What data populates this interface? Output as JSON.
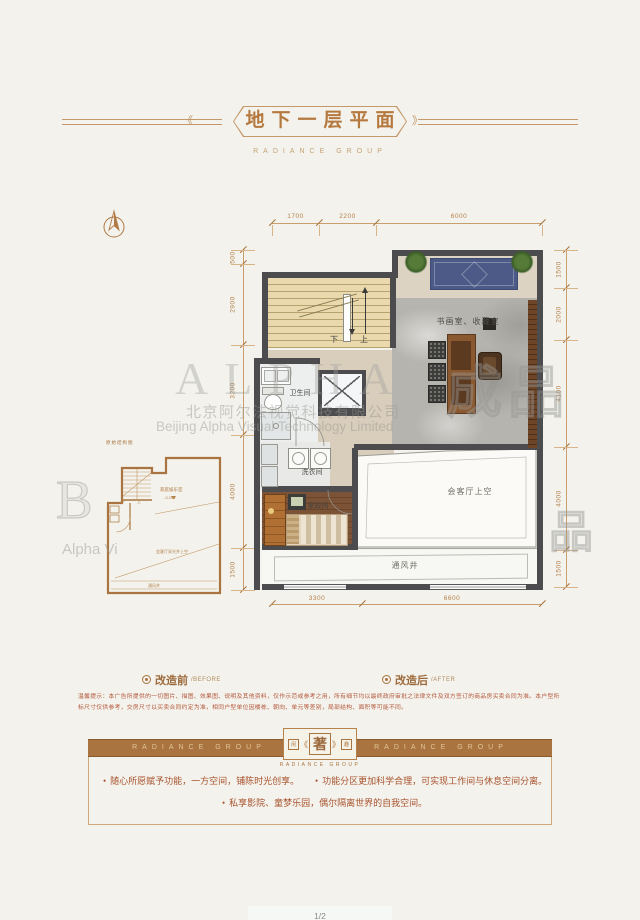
{
  "header": {
    "title": "地下一层平面",
    "subtitle": "RADIANCE GROUP",
    "decor_l": "《",
    "decor_r": "》"
  },
  "plan": {
    "room_labels": {
      "study": "书画室、收藏室",
      "bathroom": "卫生间",
      "laundry": "洗衣间",
      "maid": "家政间",
      "void": "会客厅上空",
      "vent": "通风井",
      "stair_down": "下",
      "stair_up": "上"
    },
    "dims": {
      "top": [
        "1700",
        "2200",
        "6000"
      ],
      "bottom": [
        "3300",
        "6600"
      ],
      "left": [
        "500",
        "2900",
        "3200",
        "4000",
        "1500"
      ],
      "right": [
        "1500",
        "2000",
        "4100",
        "4000",
        "1500"
      ]
    }
  },
  "before_plan": {
    "caption": "原始结构图",
    "labels": {
      "family_room": "家庭娱乐室",
      "level": "-3.200",
      "void": "会客厅采光井上空",
      "vent": "通风井",
      "stair_down": "下",
      "stair_up": "上"
    }
  },
  "legend": {
    "before_label": "改造前",
    "before_sub": "/BEFORE",
    "after_label": "改造后",
    "after_sub": "/AFTER"
  },
  "disclaimer": "温馨提示：本广告所提供的一切图片、描图、效果图、说明及其他资料，仅作示范或参考之用，所有细节均以最终政府审批之法律文件及双方签订的商品房买卖合同为准。本户型所标尺寸仅供参考，交房尺寸以买卖合同约定为准，相同户型单位因楼栋、朝向、单元等差别，局部结构、面积等可能不同。",
  "footer": {
    "band_left": "RADIANCE GROUP",
    "band_right": "RADIANCE GROUP",
    "emblem": {
      "left": "闲",
      "center": "著",
      "right": "趣",
      "decor_l": "《",
      "decor_r": "》",
      "caption": "RADIANCE GROUP"
    },
    "bullets": [
      "随心所愿赋予功能，一方空间，铺陈时光创享。",
      "功能分区更加科学合理，可实现工作间与休息空间分离。",
      "私享影院、童梦乐园，偶尔隔离世界的自我空间。"
    ]
  },
  "watermark": {
    "big_text": "ALPHA",
    "stamp": "成品",
    "stamp2": "品",
    "partial_glyph": "B",
    "partial_text": "Alpha  Vi",
    "cn_company": "北京阿尔法视觉科技有限公司",
    "en_company": "Beijing Alpha Visual Technology Limited"
  },
  "page_number": "1/2",
  "colors": {
    "accent": "#a9743f",
    "wall": "#4c4c4e",
    "dim": "#b5824d",
    "text_red": "#a8532e",
    "bg": "#f3f2ec"
  }
}
